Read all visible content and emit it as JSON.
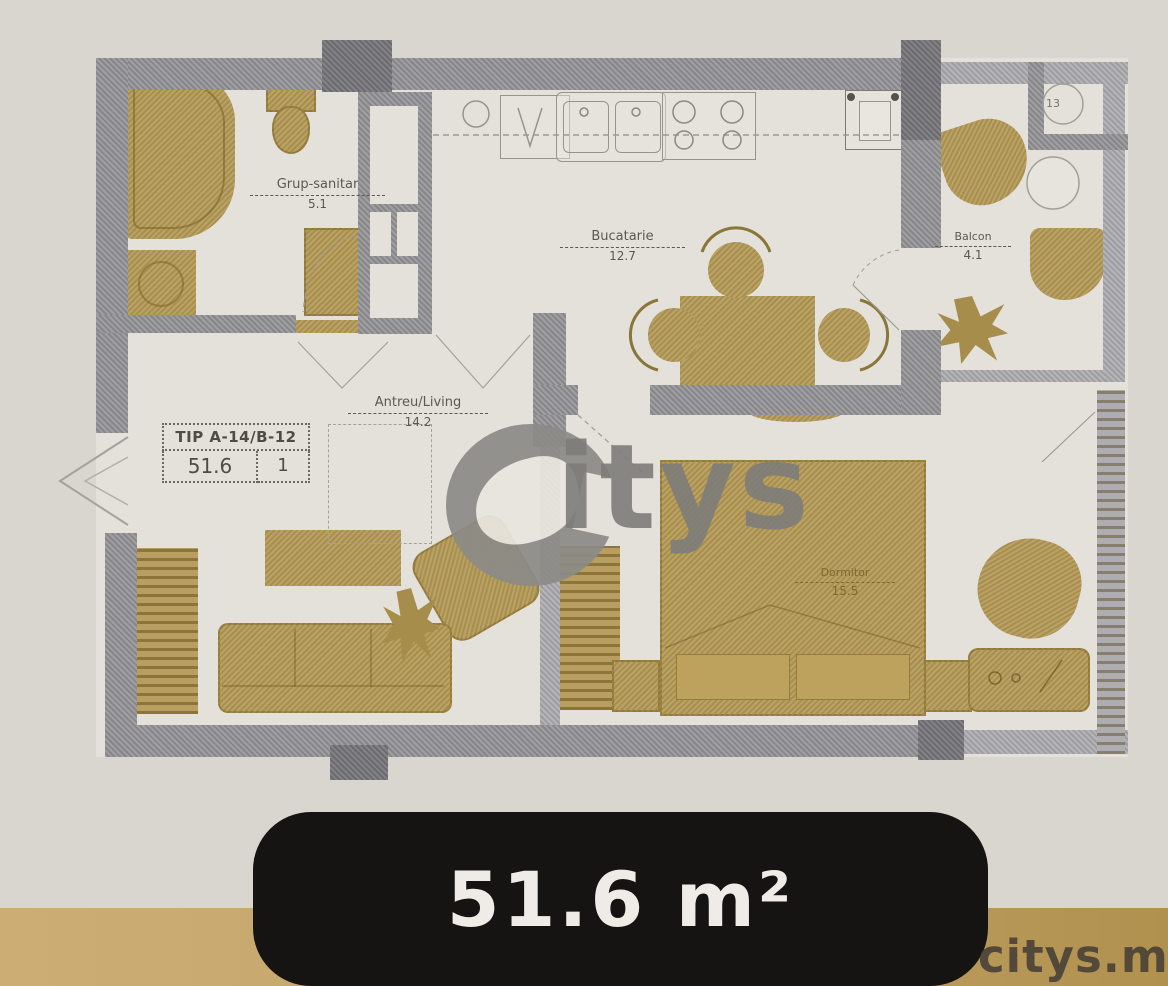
{
  "floor_plan": {
    "unit_label": {
      "type_code": "TIP A-14/B-12",
      "area": "51.6",
      "rooms": "1"
    },
    "rooms": [
      {
        "name": "Grup-sanitar",
        "area": "5.1"
      },
      {
        "name": "Bucatarie",
        "area": "12.7"
      },
      {
        "name": "Antreu/Living",
        "area": "14.2"
      },
      {
        "name": "Balcon",
        "area": "4.1"
      },
      {
        "name": "Dormitor",
        "area": "15.5"
      }
    ],
    "shaft": {
      "number": "13"
    }
  },
  "watermark": {
    "logo_text": "itys",
    "site": "citys.md"
  },
  "badge": {
    "area_label": "51.6 m²"
  },
  "colors": {
    "paper": "#d9d6d0",
    "room_fill": "#e4e1da",
    "wall": "#8f8e92",
    "wall_dark": "#757479",
    "furniture": "#b29754",
    "badge_bg": "#161412",
    "strip": "#c3a368",
    "badge_text": "#efece8",
    "site_text": "#4a4338"
  }
}
